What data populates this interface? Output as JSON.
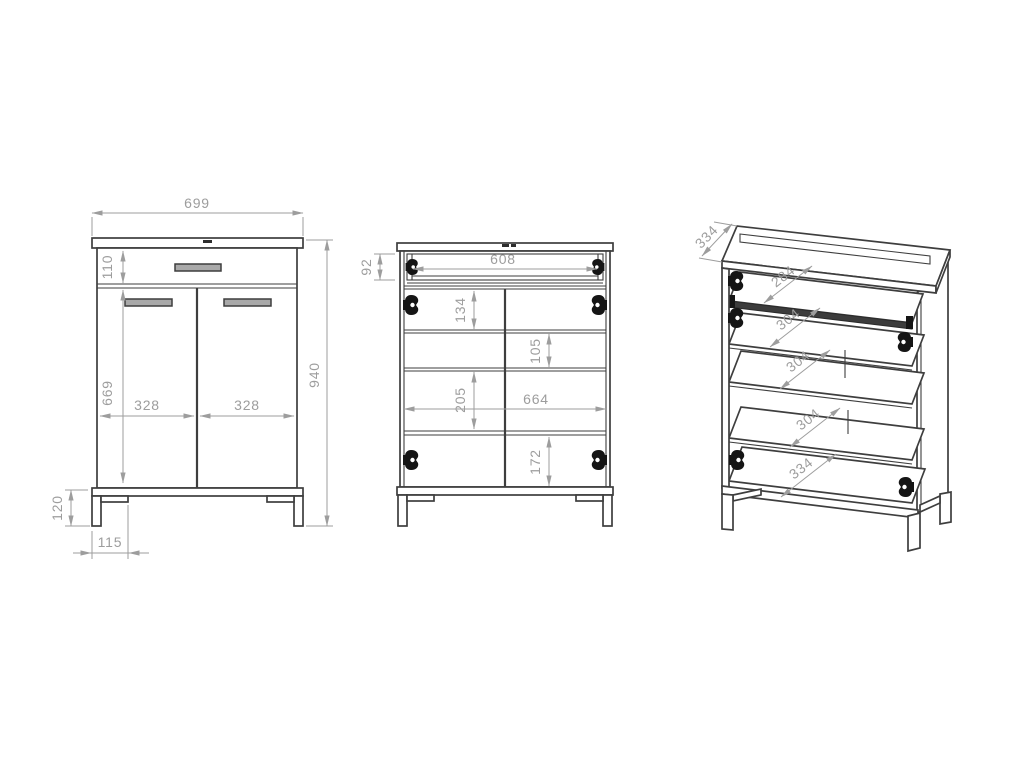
{
  "drawing": {
    "kind": "furniture-cabinet-three-view-technical-drawing",
    "views": {
      "front": {
        "dims": {
          "overall_width": "699",
          "drawer_front_height": "110",
          "door_height": "669",
          "left_door_width": "328",
          "right_door_width": "328",
          "overall_height": "940",
          "base_height": "120",
          "leg_inset": "115"
        }
      },
      "internal": {
        "dims": {
          "drawer_box_height": "92",
          "drawer_box_width": "608",
          "gap_under_drawer": "134",
          "gap_shelf_2": "105",
          "gap_shelf_3": "205",
          "interior_width": "664",
          "gap_bottom": "172"
        }
      },
      "isometric": {
        "dims": {
          "cabinet_depth": "334",
          "drawer_shelf_depth": "284",
          "shelf_2_depth": "304",
          "shelf_3_depth": "304",
          "shelf_4_depth": "304",
          "bottom_panel_depth": "334"
        }
      }
    },
    "colors": {
      "outline": "#3e3e3e",
      "dimension": "#9d9d9d",
      "hardware": "#151515",
      "background": "#ffffff"
    }
  }
}
